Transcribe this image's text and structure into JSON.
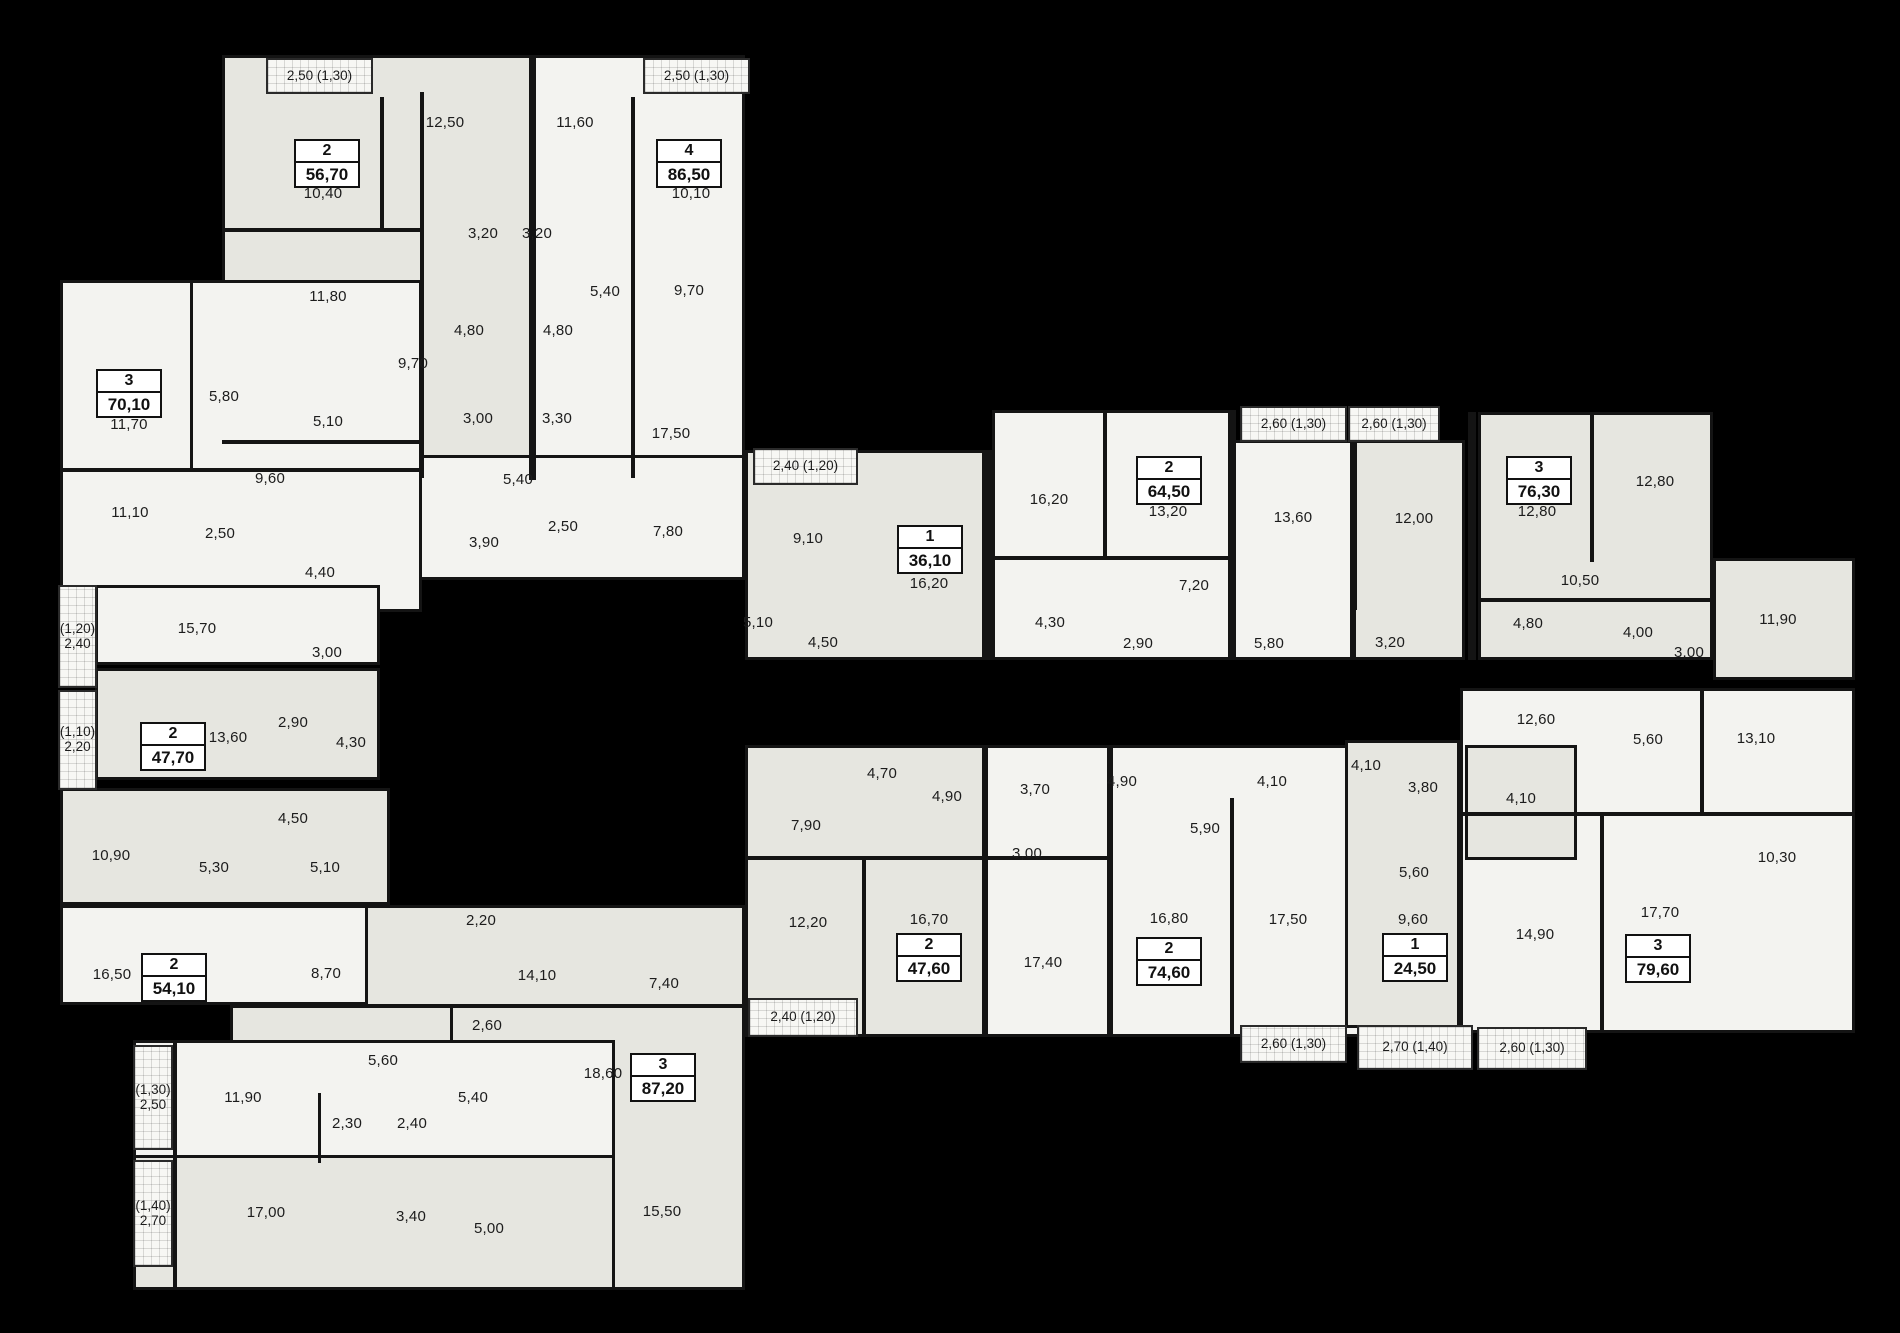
{
  "colors": {
    "background": "#000000",
    "room_white": "#f3f3f0",
    "room_gray": "#e6e6e0",
    "wall": "#141414",
    "text": "#1c1c1c",
    "badge_bg": "#ffffff"
  },
  "blocks": [
    {
      "x": 222,
      "y": 55,
      "w": 310,
      "h": 425,
      "f": "b"
    },
    {
      "x": 532,
      "y": 55,
      "w": 213,
      "h": 425,
      "f": "a"
    },
    {
      "x": 365,
      "y": 455,
      "w": 380,
      "h": 125,
      "f": "a"
    },
    {
      "x": 60,
      "y": 280,
      "w": 362,
      "h": 332,
      "f": "a"
    },
    {
      "x": 95,
      "y": 585,
      "w": 285,
      "h": 80,
      "f": "a"
    },
    {
      "x": 95,
      "y": 668,
      "w": 285,
      "h": 112,
      "f": "b"
    },
    {
      "x": 60,
      "y": 788,
      "w": 330,
      "h": 117,
      "f": "b"
    },
    {
      "x": 60,
      "y": 905,
      "w": 395,
      "h": 100,
      "f": "a"
    },
    {
      "x": 230,
      "y": 1005,
      "w": 385,
      "h": 52,
      "f": "b"
    },
    {
      "x": 365,
      "y": 905,
      "w": 380,
      "h": 102,
      "f": "b"
    },
    {
      "x": 450,
      "y": 1005,
      "w": 295,
      "h": 285,
      "f": "b"
    },
    {
      "x": 133,
      "y": 1040,
      "w": 482,
      "h": 250,
      "f": "a"
    },
    {
      "x": 133,
      "y": 1155,
      "w": 482,
      "h": 135,
      "f": "b"
    },
    {
      "x": 745,
      "y": 450,
      "w": 240,
      "h": 210,
      "f": "b"
    },
    {
      "x": 992,
      "y": 410,
      "w": 240,
      "h": 250,
      "f": "a"
    },
    {
      "x": 1232,
      "y": 440,
      "w": 121,
      "h": 220,
      "f": "a"
    },
    {
      "x": 1353,
      "y": 440,
      "w": 112,
      "h": 220,
      "f": "b"
    },
    {
      "x": 1478,
      "y": 412,
      "w": 235,
      "h": 248,
      "f": "b"
    },
    {
      "x": 1713,
      "y": 558,
      "w": 142,
      "h": 122,
      "f": "b"
    },
    {
      "x": 745,
      "y": 745,
      "w": 240,
      "h": 292,
      "f": "b"
    },
    {
      "x": 985,
      "y": 745,
      "w": 125,
      "h": 292,
      "f": "a"
    },
    {
      "x": 1110,
      "y": 745,
      "w": 250,
      "h": 292,
      "f": "a"
    },
    {
      "x": 1345,
      "y": 740,
      "w": 115,
      "h": 288,
      "f": "b"
    },
    {
      "x": 1460,
      "y": 688,
      "w": 395,
      "h": 345,
      "f": "a"
    },
    {
      "x": 1465,
      "y": 745,
      "w": 112,
      "h": 115,
      "f": "b"
    }
  ],
  "walls": [
    {
      "x": 420,
      "y": 92,
      "w": 4,
      "h": 386
    },
    {
      "x": 529,
      "y": 55,
      "w": 7,
      "h": 425
    },
    {
      "x": 631,
      "y": 97,
      "w": 4,
      "h": 381
    },
    {
      "x": 222,
      "y": 228,
      "w": 200,
      "h": 4
    },
    {
      "x": 380,
      "y": 97,
      "w": 4,
      "h": 133
    },
    {
      "x": 60,
      "y": 468,
      "w": 362,
      "h": 4
    },
    {
      "x": 222,
      "y": 440,
      "w": 200,
      "h": 4
    },
    {
      "x": 190,
      "y": 282,
      "w": 3,
      "h": 186
    },
    {
      "x": 992,
      "y": 556,
      "w": 238,
      "h": 4
    },
    {
      "x": 983,
      "y": 450,
      "w": 9,
      "h": 210
    },
    {
      "x": 1103,
      "y": 412,
      "w": 4,
      "h": 146
    },
    {
      "x": 1228,
      "y": 410,
      "w": 8,
      "h": 250
    },
    {
      "x": 1353,
      "y": 440,
      "w": 4,
      "h": 170
    },
    {
      "x": 1468,
      "y": 412,
      "w": 8,
      "h": 248
    },
    {
      "x": 1590,
      "y": 412,
      "w": 4,
      "h": 150
    },
    {
      "x": 1478,
      "y": 598,
      "w": 235,
      "h": 4
    },
    {
      "x": 748,
      "y": 856,
      "w": 360,
      "h": 4
    },
    {
      "x": 862,
      "y": 860,
      "w": 4,
      "h": 177
    },
    {
      "x": 1230,
      "y": 798,
      "w": 4,
      "h": 239
    },
    {
      "x": 1600,
      "y": 815,
      "w": 4,
      "h": 218
    },
    {
      "x": 1460,
      "y": 812,
      "w": 395,
      "h": 4
    },
    {
      "x": 1700,
      "y": 688,
      "w": 4,
      "h": 127
    },
    {
      "x": 173,
      "y": 1040,
      "w": 4,
      "h": 250
    },
    {
      "x": 318,
      "y": 1093,
      "w": 3,
      "h": 70
    }
  ],
  "balconies": [
    {
      "x": 266,
      "y": 58,
      "w": 107,
      "h": 36,
      "t": "2,50 (1,30)"
    },
    {
      "x": 643,
      "y": 58,
      "w": 107,
      "h": 36,
      "t": "2,50 (1,30)"
    },
    {
      "x": 753,
      "y": 448,
      "w": 105,
      "h": 37,
      "t": "2,40 (1,20)"
    },
    {
      "x": 1240,
      "y": 406,
      "w": 107,
      "h": 36,
      "t": "2,60 (1,30)"
    },
    {
      "x": 1348,
      "y": 406,
      "w": 92,
      "h": 36,
      "t": "2,60 (1,30)"
    },
    {
      "x": 58,
      "y": 585,
      "w": 39,
      "h": 103,
      "t": "(1,20)\n2,40"
    },
    {
      "x": 58,
      "y": 690,
      "w": 39,
      "h": 100,
      "t": "(1,10)\n2,20"
    },
    {
      "x": 133,
      "y": 1045,
      "w": 40,
      "h": 105,
      "t": "(1,30)\n2,50"
    },
    {
      "x": 133,
      "y": 1160,
      "w": 40,
      "h": 107,
      "t": "(1,40)\n2,70"
    },
    {
      "x": 748,
      "y": 998,
      "w": 110,
      "h": 39,
      "t": "2,40 (1,20)"
    },
    {
      "x": 1240,
      "y": 1025,
      "w": 107,
      "h": 38,
      "t": "2,60 (1,30)"
    },
    {
      "x": 1357,
      "y": 1025,
      "w": 116,
      "h": 45,
      "t": "2,70 (1,40)"
    },
    {
      "x": 1477,
      "y": 1027,
      "w": 110,
      "h": 43,
      "t": "2,60 (1,30)"
    }
  ],
  "apartments": [
    {
      "x": 325,
      "y": 162,
      "rooms": "2",
      "area": "56,70"
    },
    {
      "x": 687,
      "y": 162,
      "rooms": "4",
      "area": "86,50"
    },
    {
      "x": 127,
      "y": 392,
      "rooms": "3",
      "area": "70,10"
    },
    {
      "x": 171,
      "y": 745,
      "rooms": "2",
      "area": "47,70"
    },
    {
      "x": 172,
      "y": 976,
      "rooms": "2",
      "area": "54,10"
    },
    {
      "x": 661,
      "y": 1076,
      "rooms": "3",
      "area": "87,20"
    },
    {
      "x": 928,
      "y": 548,
      "rooms": "1",
      "area": "36,10"
    },
    {
      "x": 1167,
      "y": 479,
      "rooms": "2",
      "area": "64,50"
    },
    {
      "x": 1537,
      "y": 479,
      "rooms": "3",
      "area": "76,30"
    },
    {
      "x": 927,
      "y": 956,
      "rooms": "2",
      "area": "47,60"
    },
    {
      "x": 1167,
      "y": 960,
      "rooms": "2",
      "area": "74,60"
    },
    {
      "x": 1413,
      "y": 956,
      "rooms": "1",
      "area": "24,50"
    },
    {
      "x": 1656,
      "y": 957,
      "rooms": "3",
      "area": "79,60"
    }
  ],
  "rooms": [
    {
      "x": 445,
      "y": 123,
      "t": "12,50"
    },
    {
      "x": 575,
      "y": 123,
      "t": "11,60"
    },
    {
      "x": 323,
      "y": 194,
      "t": "10,40"
    },
    {
      "x": 691,
      "y": 194,
      "t": "10,10"
    },
    {
      "x": 483,
      "y": 234,
      "t": "3,20"
    },
    {
      "x": 537,
      "y": 234,
      "t": "3,20"
    },
    {
      "x": 328,
      "y": 297,
      "t": "11,80"
    },
    {
      "x": 605,
      "y": 292,
      "t": "5,40"
    },
    {
      "x": 689,
      "y": 291,
      "t": "9,70"
    },
    {
      "x": 469,
      "y": 331,
      "t": "4,80"
    },
    {
      "x": 558,
      "y": 331,
      "t": "4,80"
    },
    {
      "x": 413,
      "y": 364,
      "t": "9,70"
    },
    {
      "x": 478,
      "y": 419,
      "t": "3,00"
    },
    {
      "x": 557,
      "y": 419,
      "t": "3,30"
    },
    {
      "x": 671,
      "y": 434,
      "t": "17,50"
    },
    {
      "x": 518,
      "y": 480,
      "t": "5,40"
    },
    {
      "x": 563,
      "y": 527,
      "t": "2,50"
    },
    {
      "x": 484,
      "y": 543,
      "t": "3,90"
    },
    {
      "x": 668,
      "y": 532,
      "t": "7,80"
    },
    {
      "x": 224,
      "y": 397,
      "t": "5,80"
    },
    {
      "x": 129,
      "y": 425,
      "t": "11,70"
    },
    {
      "x": 328,
      "y": 422,
      "t": "5,10"
    },
    {
      "x": 270,
      "y": 479,
      "t": "9,60"
    },
    {
      "x": 130,
      "y": 513,
      "t": "11,10"
    },
    {
      "x": 220,
      "y": 534,
      "t": "2,50"
    },
    {
      "x": 320,
      "y": 573,
      "t": "4,40"
    },
    {
      "x": 197,
      "y": 629,
      "t": "15,70"
    },
    {
      "x": 327,
      "y": 653,
      "t": "3,00"
    },
    {
      "x": 228,
      "y": 738,
      "t": "13,60"
    },
    {
      "x": 293,
      "y": 723,
      "t": "2,90"
    },
    {
      "x": 351,
      "y": 743,
      "t": "4,30"
    },
    {
      "x": 293,
      "y": 819,
      "t": "4,50"
    },
    {
      "x": 111,
      "y": 856,
      "t": "10,90"
    },
    {
      "x": 214,
      "y": 868,
      "t": "5,30"
    },
    {
      "x": 325,
      "y": 868,
      "t": "5,10"
    },
    {
      "x": 112,
      "y": 975,
      "t": "16,50"
    },
    {
      "x": 326,
      "y": 974,
      "t": "8,70"
    },
    {
      "x": 487,
      "y": 1026,
      "t": "2,60"
    },
    {
      "x": 383,
      "y": 1061,
      "t": "5,60"
    },
    {
      "x": 243,
      "y": 1098,
      "t": "11,90"
    },
    {
      "x": 347,
      "y": 1124,
      "t": "2,30"
    },
    {
      "x": 412,
      "y": 1124,
      "t": "2,40"
    },
    {
      "x": 473,
      "y": 1098,
      "t": "5,40"
    },
    {
      "x": 266,
      "y": 1213,
      "t": "17,00"
    },
    {
      "x": 411,
      "y": 1217,
      "t": "3,40"
    },
    {
      "x": 489,
      "y": 1229,
      "t": "5,00"
    },
    {
      "x": 481,
      "y": 921,
      "t": "2,20"
    },
    {
      "x": 537,
      "y": 976,
      "t": "14,10"
    },
    {
      "x": 664,
      "y": 984,
      "t": "7,40"
    },
    {
      "x": 603,
      "y": 1074,
      "t": "18,60"
    },
    {
      "x": 662,
      "y": 1212,
      "t": "15,50"
    },
    {
      "x": 808,
      "y": 539,
      "t": "9,10"
    },
    {
      "x": 929,
      "y": 584,
      "t": "16,20"
    },
    {
      "x": 758,
      "y": 623,
      "t": "5,10"
    },
    {
      "x": 823,
      "y": 643,
      "t": "4,50"
    },
    {
      "x": 1049,
      "y": 500,
      "t": "16,20"
    },
    {
      "x": 1168,
      "y": 512,
      "t": "13,20"
    },
    {
      "x": 1194,
      "y": 586,
      "t": "7,20"
    },
    {
      "x": 1050,
      "y": 623,
      "t": "4,30"
    },
    {
      "x": 1138,
      "y": 644,
      "t": "2,90"
    },
    {
      "x": 1293,
      "y": 518,
      "t": "13,60"
    },
    {
      "x": 1414,
      "y": 519,
      "t": "12,00"
    },
    {
      "x": 1269,
      "y": 644,
      "t": "5,80"
    },
    {
      "x": 1390,
      "y": 643,
      "t": "3,20"
    },
    {
      "x": 1537,
      "y": 512,
      "t": "12,80"
    },
    {
      "x": 1655,
      "y": 482,
      "t": "12,80"
    },
    {
      "x": 1580,
      "y": 581,
      "t": "10,50"
    },
    {
      "x": 1528,
      "y": 624,
      "t": "4,80"
    },
    {
      "x": 1638,
      "y": 633,
      "t": "4,00"
    },
    {
      "x": 1689,
      "y": 653,
      "t": "3,00"
    },
    {
      "x": 1778,
      "y": 620,
      "t": "11,90"
    },
    {
      "x": 882,
      "y": 774,
      "t": "4,70"
    },
    {
      "x": 806,
      "y": 826,
      "t": "7,90"
    },
    {
      "x": 947,
      "y": 797,
      "t": "4,90"
    },
    {
      "x": 808,
      "y": 923,
      "t": "12,20"
    },
    {
      "x": 929,
      "y": 920,
      "t": "16,70"
    },
    {
      "x": 1043,
      "y": 963,
      "t": "17,40"
    },
    {
      "x": 1035,
      "y": 790,
      "t": "3,70"
    },
    {
      "x": 1122,
      "y": 782,
      "t": "4,90"
    },
    {
      "x": 1205,
      "y": 829,
      "t": "5,90"
    },
    {
      "x": 1272,
      "y": 782,
      "t": "4,10"
    },
    {
      "x": 1027,
      "y": 854,
      "t": "3,00"
    },
    {
      "x": 1169,
      "y": 919,
      "t": "16,80"
    },
    {
      "x": 1288,
      "y": 920,
      "t": "17,50"
    },
    {
      "x": 1366,
      "y": 766,
      "t": "4,10"
    },
    {
      "x": 1423,
      "y": 788,
      "t": "3,80"
    },
    {
      "x": 1414,
      "y": 873,
      "t": "5,60"
    },
    {
      "x": 1413,
      "y": 920,
      "t": "9,60"
    },
    {
      "x": 1521,
      "y": 799,
      "t": "4,10"
    },
    {
      "x": 1536,
      "y": 720,
      "t": "12,60"
    },
    {
      "x": 1648,
      "y": 740,
      "t": "5,60"
    },
    {
      "x": 1756,
      "y": 739,
      "t": "13,10"
    },
    {
      "x": 1535,
      "y": 935,
      "t": "14,90"
    },
    {
      "x": 1660,
      "y": 913,
      "t": "17,70"
    },
    {
      "x": 1777,
      "y": 858,
      "t": "10,30"
    }
  ]
}
